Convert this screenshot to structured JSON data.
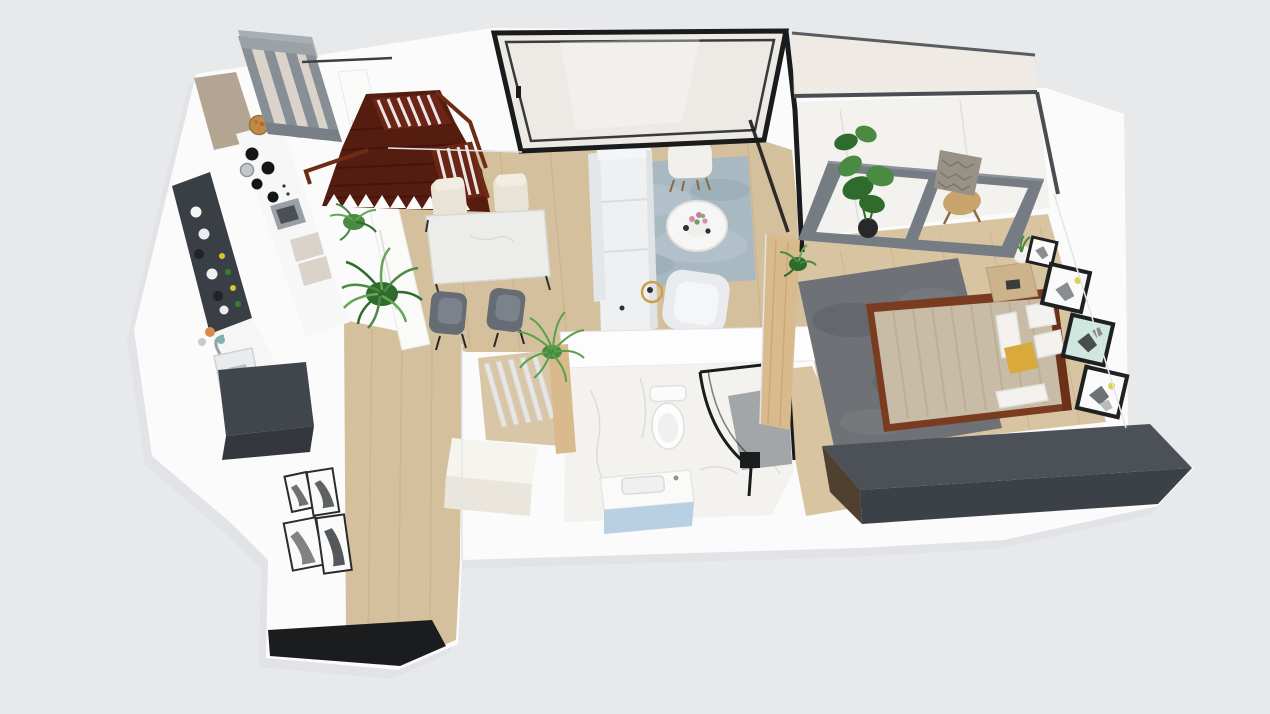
{
  "scene": {
    "title": "3D isometric apartment floor plan render",
    "view": "axonometric top-down"
  },
  "colors": {
    "bg": "#e8e9eb",
    "slab": "#fbfbfc",
    "slab_shadow": "#dcdee1",
    "wood": "#d5c09d",
    "wood_bedroom": "#d8c4a1",
    "wood_line": "#b59a72",
    "marble": "#f3f2ef",
    "marble_vein": "#dcdbd7",
    "wall_line": "#e3e4e6",
    "dark_counter": "#3a3f45",
    "dark_box": "#41464d",
    "cab_wood": "#b4a492",
    "stair": "#551c10",
    "stair_rail": "#6e2c15",
    "pergola_top": "#a7aeb4",
    "pergola": "#878e95",
    "pergola_light": "#9aa1a7",
    "pergola_dark": "#787f86",
    "pergola_panel": "#d9d3c9",
    "table_marble": "#ececea",
    "chair_cream": "#e9e3d6",
    "chair_gray": "#666c73",
    "sofa": "#eef0f2",
    "sofa_shade": "#dfe3e6",
    "rug_blue": "#a9b9c2",
    "rug_blue_light": "#bac8d0",
    "tv": "#17181a",
    "gold": "#c9a24a",
    "partition": "#d9ba8c",
    "rug_gray": "#6e7175",
    "rug_gray_dark": "#5d6064",
    "bed_frame": "#7a3c20",
    "duvet": "#c8bca6",
    "duvet_line": "#b0a38b",
    "pillow": "#f3f2ef",
    "accent_yellow": "#d9a93c",
    "credenza_top": "#4b5157",
    "credenza_front": "#3c4147",
    "frame_black": "#1f2022",
    "art_white": "#fafafa",
    "art_mint": "#cfe7df",
    "art_gray": "#8a8d90",
    "balcony_frame": "#767c83",
    "balcony_rail": "#4a4e53",
    "glass_cream": "#efe9e2",
    "window_black": "#1a1b1d",
    "window_glass": "#edeae5",
    "plant_dark": "#2f6b2d",
    "plant_mid": "#4a8a42",
    "plant_light": "#63a653",
    "plant_bright": "#5ba048",
    "pot_dark": "#26282a",
    "vanity_blue": "#b9cfe3",
    "shower_floor": "#999da0",
    "fixture_black": "#1b1c1e",
    "doormat": "#1b1c1e",
    "white_cube": "#f6f4ef",
    "white_cube_side": "#eae6dd",
    "chair_tan": "#c9a36c",
    "blanket": "#989186"
  },
  "rooms": {
    "kitchen": {
      "label": "Kitchen",
      "items": [
        "dark bar counter with plates and bottles",
        "sink with chrome faucet",
        "cooktop with black burners",
        "oven",
        "dark appliance box",
        "tall wood cabinets",
        "fruit bowl",
        "gray ceiling beam frame"
      ]
    },
    "staircase": {
      "label": "Staircase",
      "items": [
        "dark mahogany L-shaped stairs",
        "white balusters",
        "brown handrail",
        "sawtooth stringer"
      ]
    },
    "dining": {
      "label": "Dining area",
      "items": [
        "marble dining table",
        "two cream chairs",
        "two gray chairs"
      ]
    },
    "living": {
      "label": "Living room",
      "items": [
        "white sofa",
        "blue-gray rug",
        "round coffee table with flowers",
        "white armchair",
        "accent chair",
        "gold side table",
        "wall TV",
        "black framed window wall"
      ]
    },
    "bedroom": {
      "label": "Bedroom",
      "items": [
        "wood framed double bed",
        "beige duvet",
        "white pillows",
        "yellow cushion",
        "gray shag rug",
        "nightstand with planter",
        "three wall art frames",
        "dark credenza wall"
      ]
    },
    "balcony": {
      "label": "Balcony",
      "items": [
        "glass railing",
        "gray sliding door frame",
        "monstera plant in pot",
        "tan lounge chair with patterned blanket",
        "marble floor"
      ]
    },
    "bathroom": {
      "label": "Bathroom",
      "items": [
        "toilet",
        "curved glass shower with black frame",
        "black shower fixture",
        "vanity with blue cabinet",
        "white storage cube",
        "wood slat screen",
        "marble floor"
      ]
    },
    "hallway": {
      "label": "Entry hallway",
      "items": [
        "leaning black and white art frames",
        "black doormat",
        "wood plank floor"
      ]
    }
  }
}
